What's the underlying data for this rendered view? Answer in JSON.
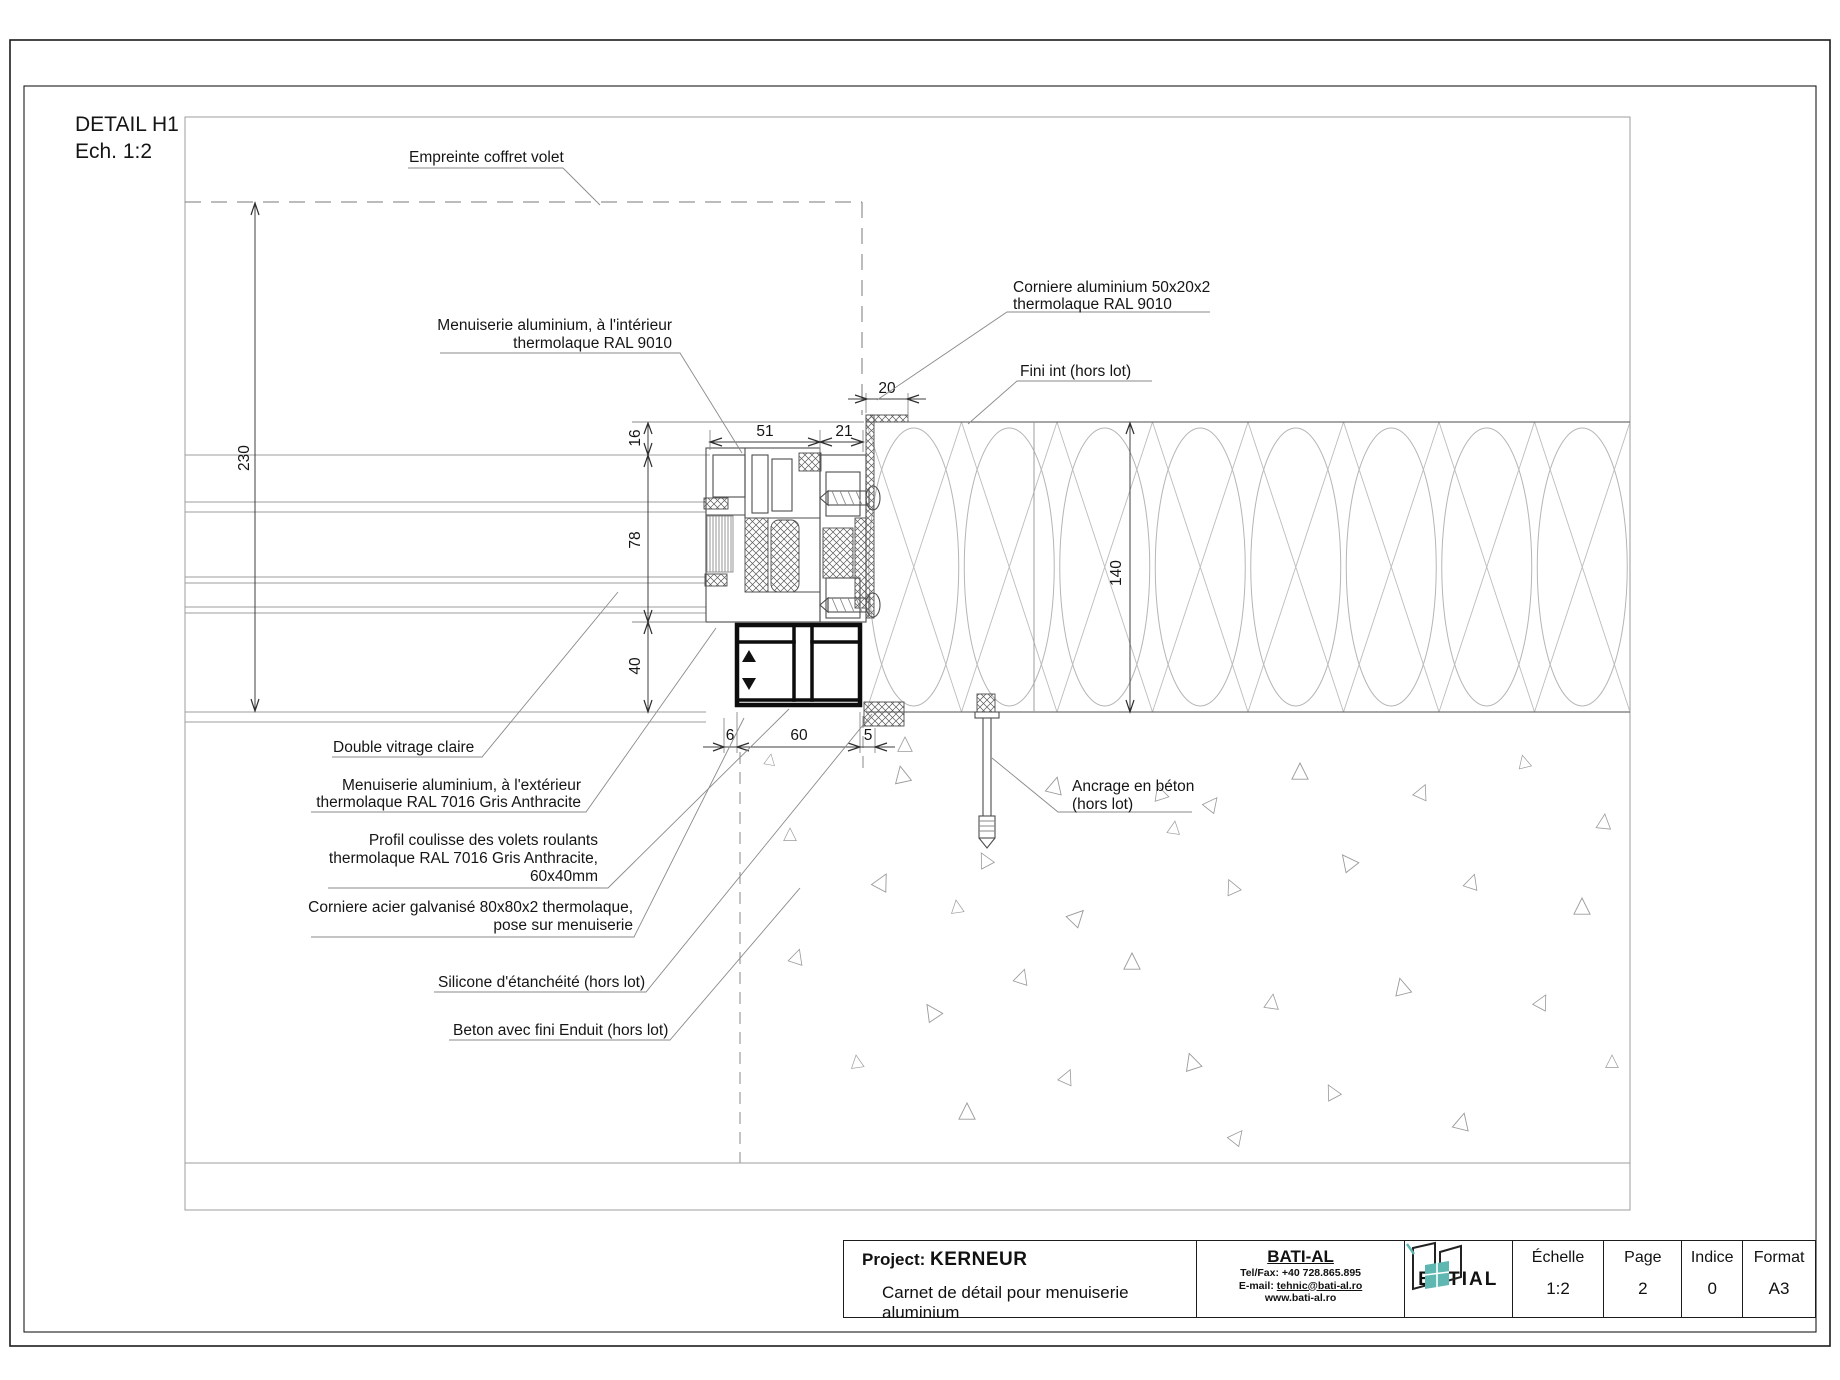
{
  "page": {
    "detail_title": "DETAIL H1",
    "detail_scale": "Ech. 1:2"
  },
  "labels": {
    "empreinte": "Empreinte coffret volet",
    "menuiserie_int_1": "Menuiserie aluminium, à l'intérieur",
    "menuiserie_int_2": "thermolaque RAL 9010",
    "corniere_alu_1": "Corniere aluminium 50x20x2",
    "corniere_alu_2": "thermolaque RAL 9010",
    "fini_int": "Fini int (hors lot)",
    "double_vitrage": "Double vitrage claire",
    "menuiserie_ext_1": "Menuiserie aluminium, à l'extérieur",
    "menuiserie_ext_2": "thermolaque RAL 7016 Gris Anthracite",
    "profil_1": "Profil coulisse des volets roulants",
    "profil_2": "thermolaque RAL 7016 Gris Anthracite,",
    "profil_3": "60x40mm",
    "corniere_acier_1": "Corniere acier galvanisé 80x80x2 thermolaque,",
    "corniere_acier_2": "pose sur menuiserie",
    "silicone": "Silicone d'étanchéité (hors lot)",
    "beton": "Beton avec fini Enduit (hors lot)",
    "ancrage_1": "Ancrage en béton",
    "ancrage_2": "(hors lot)"
  },
  "dimensions": {
    "d230": "230",
    "d16": "16",
    "d78": "78",
    "d40": "40",
    "d51": "51",
    "d21": "21",
    "d20": "20",
    "d140": "140",
    "d6": "6",
    "d60": "60",
    "d5": "5"
  },
  "titleblock": {
    "project_label": "Project:",
    "project_name": "KERNEUR",
    "subtitle": "Carnet de détail pour menuiserie aluminium",
    "company": "BATI-AL",
    "telfax": "Tel/Fax: +40 728.865.895",
    "email_label": "E-mail:",
    "email": "tehnic@bati-al.ro",
    "website": "www.bati-al.ro",
    "logo_left": "BATI",
    "logo_right": "AL",
    "scale_label": "Échelle",
    "scale_value": "1:2",
    "page_label": "Page",
    "page_value": "2",
    "indice_label": "Indice",
    "indice_value": "0",
    "format_label": "Format",
    "format_value": "A3"
  },
  "colors": {
    "accent_teal": "#5fb7b2",
    "line_dark": "#2e2e2e"
  },
  "concrete_triangles": [
    [
      905,
      745,
      0,
      0.8
    ],
    [
      902,
      775,
      -12,
      0.9
    ],
    [
      1055,
      786,
      14,
      0.9
    ],
    [
      1160,
      793,
      -18,
      0.8
    ],
    [
      1212,
      804,
      38,
      0.8
    ],
    [
      1174,
      828,
      8,
      0.7
    ],
    [
      985,
      860,
      -28,
      0.8
    ],
    [
      1300,
      772,
      0,
      0.9
    ],
    [
      1422,
      792,
      24,
      0.8
    ],
    [
      1524,
      762,
      -14,
      0.7
    ],
    [
      1604,
      822,
      6,
      0.8
    ],
    [
      1348,
      862,
      -38,
      0.9
    ],
    [
      1472,
      882,
      18,
      0.8
    ],
    [
      1582,
      907,
      0,
      0.9
    ],
    [
      882,
      882,
      28,
      0.9
    ],
    [
      957,
      907,
      -8,
      0.7
    ],
    [
      1077,
      917,
      44,
      0.9
    ],
    [
      1232,
      887,
      -24,
      0.8
    ],
    [
      1132,
      962,
      0,
      0.9
    ],
    [
      1022,
      977,
      18,
      0.8
    ],
    [
      932,
      1012,
      -34,
      0.9
    ],
    [
      1272,
      1002,
      8,
      0.8
    ],
    [
      1402,
      987,
      -14,
      0.9
    ],
    [
      1542,
      1002,
      28,
      0.8
    ],
    [
      1612,
      1062,
      0,
      0.7
    ],
    [
      1192,
      1062,
      -18,
      0.9
    ],
    [
      1067,
      1077,
      24,
      0.8
    ],
    [
      967,
      1112,
      0,
      0.9
    ],
    [
      1332,
      1092,
      -28,
      0.8
    ],
    [
      1462,
      1122,
      14,
      0.9
    ],
    [
      1237,
      1137,
      38,
      0.8
    ],
    [
      857,
      1062,
      -8,
      0.7
    ],
    [
      797,
      957,
      18,
      0.8
    ],
    [
      790,
      835,
      0,
      0.7
    ],
    [
      770,
      760,
      10,
      0.6
    ]
  ]
}
